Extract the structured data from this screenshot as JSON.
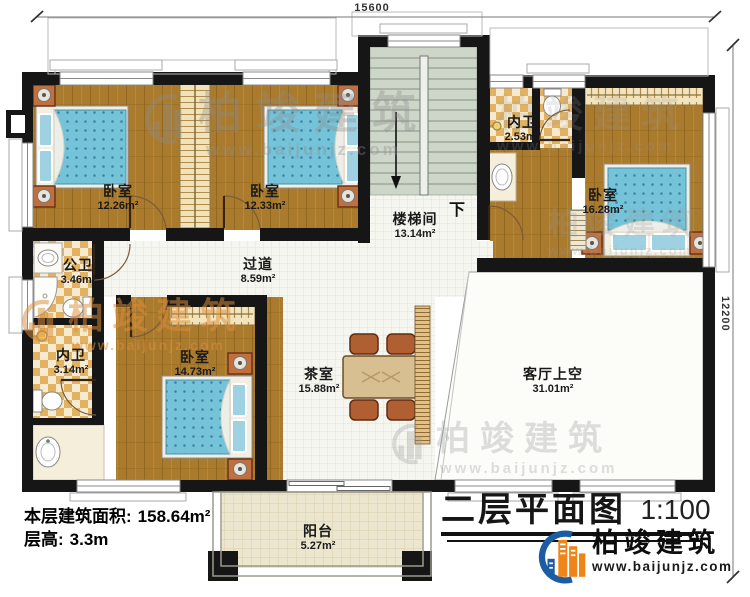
{
  "plan": {
    "title": "二层平面图",
    "scale": "1:100",
    "top_dimension": "15600",
    "right_dimension": "12200",
    "stair_direction_label": "下"
  },
  "info": {
    "floor_area_label": "本层建筑面积:",
    "floor_area_value": "158.64m²",
    "floor_height_label": "层高:",
    "floor_height_value": "3.3m"
  },
  "rooms": {
    "bedroom_nw": {
      "name": "卧室",
      "area": "12.26m²"
    },
    "bedroom_n": {
      "name": "卧室",
      "area": "12.33m²"
    },
    "bedroom_e": {
      "name": "卧室",
      "area": "16.28m²"
    },
    "bedroom_sw": {
      "name": "卧室",
      "area": "14.73m²"
    },
    "stairwell": {
      "name": "楼梯间",
      "area": "13.14m²"
    },
    "bath_public": {
      "name": "公卫",
      "area": "3.46m²"
    },
    "bath_ensuite_n": {
      "name": "内卫",
      "area": "2.53m²"
    },
    "bath_ensuite_w": {
      "name": "内卫",
      "area": "3.14m²"
    },
    "hallway": {
      "name": "过道",
      "area": "8.59m²"
    },
    "tea_room": {
      "name": "茶室",
      "area": "15.88m²"
    },
    "living_void": {
      "name": "客厅上空",
      "area": "31.01m²"
    },
    "balcony": {
      "name": "阳台",
      "area": "5.27m²"
    }
  },
  "brand": {
    "name": "柏竣建筑",
    "url": "www.baijunjz.com"
  },
  "colors": {
    "brand_blue": "#1c5ca5",
    "brand_orange": "#ef8418",
    "wood_floor": "#aa7a2d",
    "bed_blue": "#74c3d9",
    "stair_green": "#cdd6c9",
    "wall": "#161616",
    "checker_tan": "#e2b261"
  }
}
